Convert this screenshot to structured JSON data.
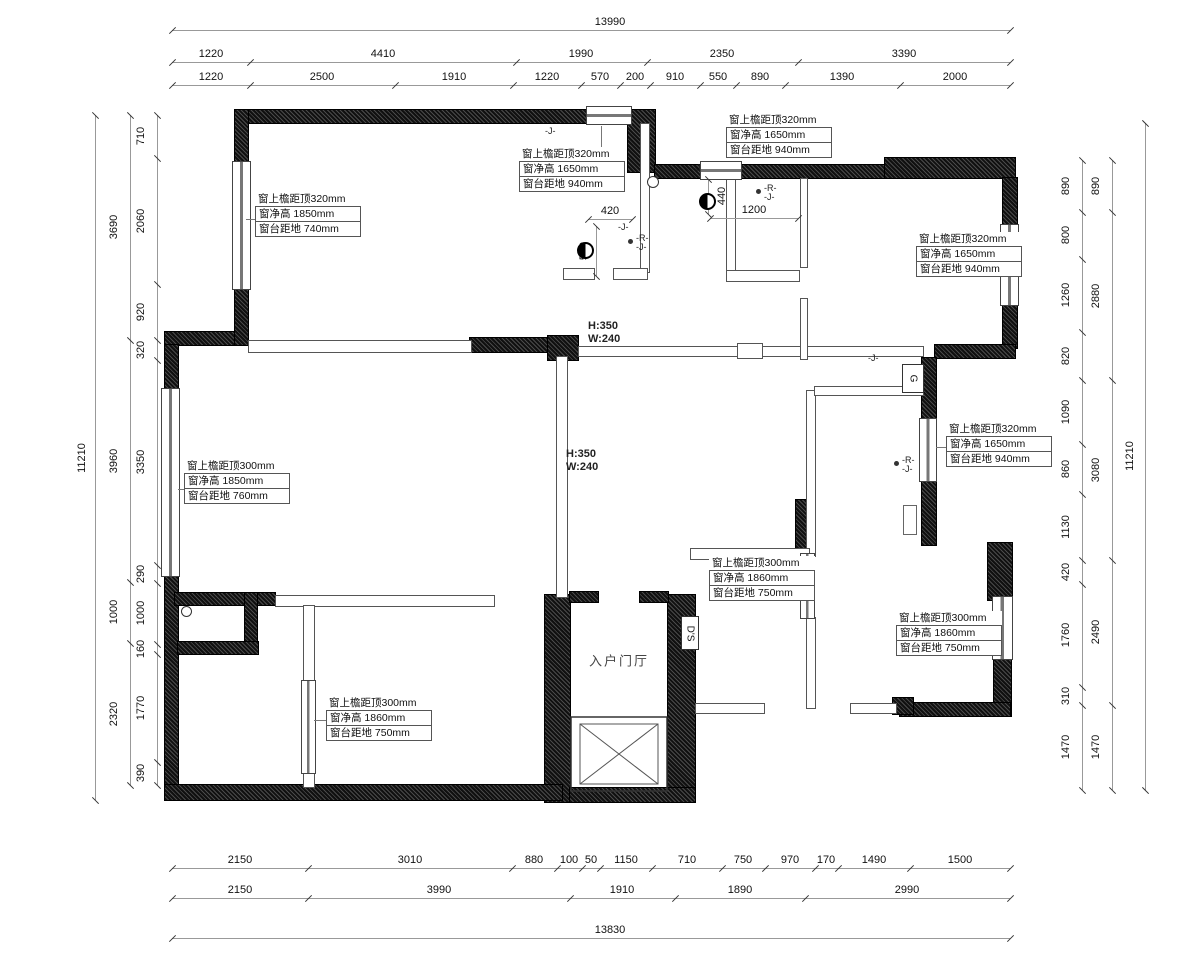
{
  "dims": {
    "top": {
      "total": "13990",
      "row2": [
        "1220",
        "4410",
        "1990",
        "2350",
        "3390"
      ],
      "row3": [
        "1220",
        "2500",
        "1910",
        "1220",
        "570",
        "200",
        "910",
        "550",
        "890",
        "1390",
        "2000"
      ]
    },
    "bottom": {
      "row1": [
        "2150",
        "3010",
        "880",
        "100",
        "50",
        "1150",
        "710",
        "750",
        "970",
        "170",
        "1490",
        "1500"
      ],
      "row2": [
        "2150",
        "3990",
        "1910",
        "1890",
        "2990"
      ],
      "total": "13830"
    },
    "left": {
      "total": "11210",
      "mid": [
        "3690",
        "3960",
        "1000",
        "2320"
      ],
      "inner": [
        "710",
        "2060",
        "920",
        "320",
        "3350",
        "290",
        "1000",
        "160",
        "1770",
        "390"
      ]
    },
    "right": {
      "inner": [
        "890",
        "800",
        "1260",
        "820",
        "1090",
        "860",
        "1130",
        "420",
        "1760",
        "310",
        "1470"
      ],
      "mid": [
        "890",
        "2880",
        "3080",
        "2490",
        "1470"
      ],
      "total": "11210"
    }
  },
  "ann": [
    {
      "l1": "窗上檐距顶320mm",
      "l2": "窗净高  1850mm",
      "l3": "窗台距地  740mm"
    },
    {
      "l1": "窗上檐距顶320mm",
      "l2": "窗净高  1650mm",
      "l3": "窗台距地  940mm"
    },
    {
      "l1": "窗上檐距顶320mm",
      "l2": "窗净高  1650mm",
      "l3": "窗台距地  940mm"
    },
    {
      "l1": "窗上檐距顶320mm",
      "l2": "窗净高  1650mm",
      "l3": "窗台距地  940mm"
    },
    {
      "l1": "窗上檐距顶320mm",
      "l2": "窗净高  1650mm",
      "l3": "窗台距地  940mm"
    },
    {
      "l1": "窗上檐距顶300mm",
      "l2": "窗净高  1850mm",
      "l3": "窗台距地  760mm"
    },
    {
      "l1": "窗上檐距顶300mm",
      "l2": "窗净高  1860mm",
      "l3": "窗台距地  750mm"
    },
    {
      "l1": "窗上檐距顶300mm",
      "l2": "窗净高  1860mm",
      "l3": "窗台距地  750mm"
    },
    {
      "l1": "窗上檐距顶300mm",
      "l2": "窗净高  1860mm",
      "l3": "窗台距地  750mm"
    }
  ],
  "labels": {
    "beam_h": "H:350",
    "beam_w": "W:240",
    "entry_hall": "入户门厅",
    "ds": "D'S",
    "g": "G",
    "d420": "420",
    "d570": "570",
    "d440": "440",
    "d1200": "1200",
    "r": "-R-",
    "j": "-J-",
    "j2": "-J"
  }
}
